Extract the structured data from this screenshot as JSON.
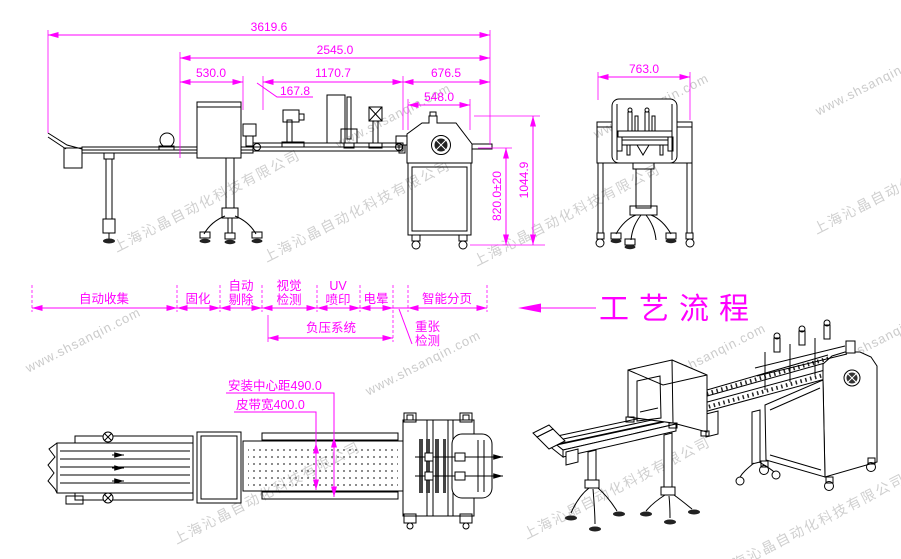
{
  "drawing": {
    "dims": {
      "overall_length": "3619.6",
      "line_length": "2545.0",
      "seg_530": "530.0",
      "seg_1170": "1170.7",
      "seg_676": "676.5",
      "seg_167": "167.8",
      "seg_548": "548.0",
      "front_width": "763.0",
      "belt_height": "820.0±20",
      "machine_height": "1044.9",
      "center_distance": "安装中心距490.0",
      "belt_width": "皮带宽400.0"
    },
    "process_flow": {
      "title": "工艺流程",
      "stages": [
        {
          "label": "自动收集"
        },
        {
          "label": "固化"
        },
        {
          "label": "自动",
          "label2": "剔除"
        },
        {
          "label": "视觉",
          "label2": "检测"
        },
        {
          "label": "UV",
          "label2": "喷印"
        },
        {
          "label": "电晕"
        },
        {
          "label": "智能分页"
        }
      ],
      "vacuum_system": "负压系统",
      "double_sheet_l1": "重张",
      "double_sheet_l2": "检测"
    },
    "watermark": {
      "company": "上海沁晶自动化科技有限公司",
      "url": "www.shsanqin.com"
    },
    "colors": {
      "dimension": "#ff00ff",
      "line_art": "#000000",
      "watermark": "#a8a8a8"
    }
  }
}
